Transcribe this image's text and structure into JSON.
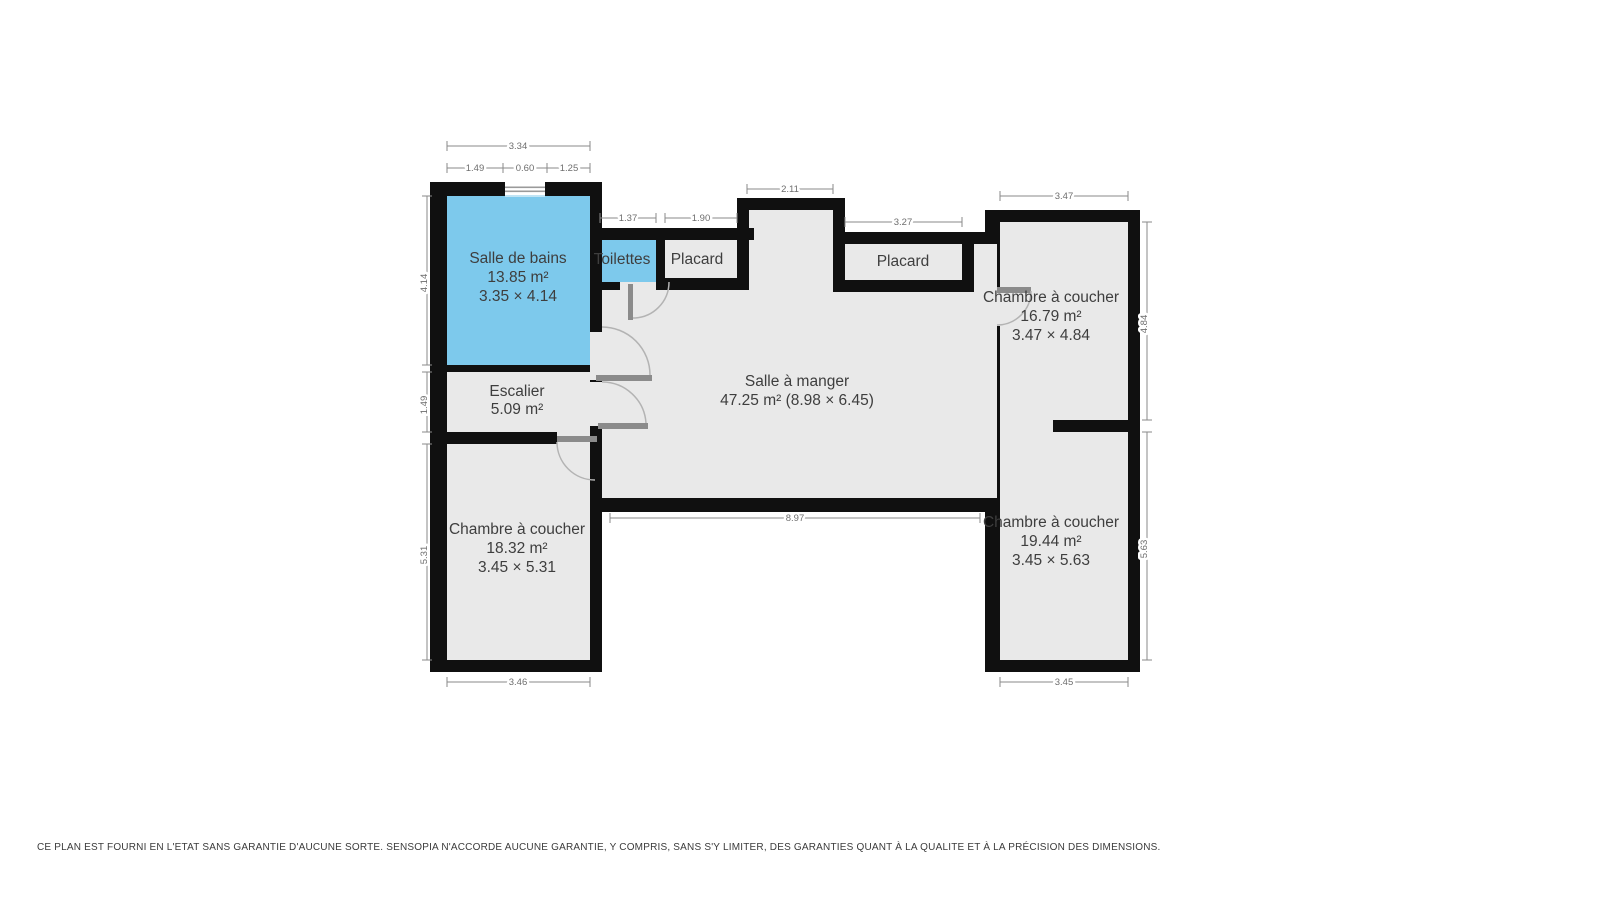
{
  "rooms": {
    "bathroom": {
      "name": "Salle de bains",
      "area": "13.85 m²",
      "size": "3.35 × 4.14"
    },
    "toilet": {
      "name": "Toilettes"
    },
    "closet1": {
      "name": "Placard"
    },
    "closet2": {
      "name": "Placard"
    },
    "dining": {
      "name": "Salle à manger",
      "area": "47.25 m² (8.98 × 6.45)"
    },
    "stairs": {
      "name": "Escalier",
      "area": "5.09 m²"
    },
    "bedroom_tr": {
      "name": "Chambre à coucher",
      "area": "16.79 m²",
      "size": "3.47 × 4.84"
    },
    "bedroom_bl": {
      "name": "Chambre à coucher",
      "area": "18.32 m²",
      "size": "3.45 × 5.31"
    },
    "bedroom_br": {
      "name": "Chambre à coucher",
      "area": "19.44 m²",
      "size": "3.45 × 5.63"
    }
  },
  "dimensions": {
    "bath_total_width": "3.34",
    "bath_seg_left": "1.49",
    "bath_window": "0.60",
    "bath_seg_right": "1.25",
    "bath_height": "4.14",
    "stairs_height": "1.49",
    "bedroom_bl_height": "5.31",
    "bedroom_bl_width": "3.46",
    "toilet_width": "1.37",
    "closet1_width": "1.90",
    "recess_width": "2.11",
    "closet2_width": "3.27",
    "bedroom_tr_width": "3.47",
    "bedroom_tr_height": "4.84",
    "dining_width": "8.97",
    "bedroom_br_width": "3.45",
    "bedroom_br_height": "5.63"
  },
  "colors": {
    "wet_room_fill": "#7dc9ec",
    "room_fill": "#e9e9e9",
    "wall": "#101010",
    "dim_text": "#6e6e6e",
    "label_text": "#3e3e3e"
  },
  "footer": {
    "disclaimer": "CE PLAN EST FOURNI EN L'ETAT SANS GARANTIE D'AUCUNE SORTE. SENSOPIA N'ACCORDE AUCUNE GARANTIE, Y COMPRIS, SANS S'Y LIMITER, DES GARANTIES QUANT À LA QUALITE ET À LA PRÉCISION DES DIMENSIONS."
  }
}
